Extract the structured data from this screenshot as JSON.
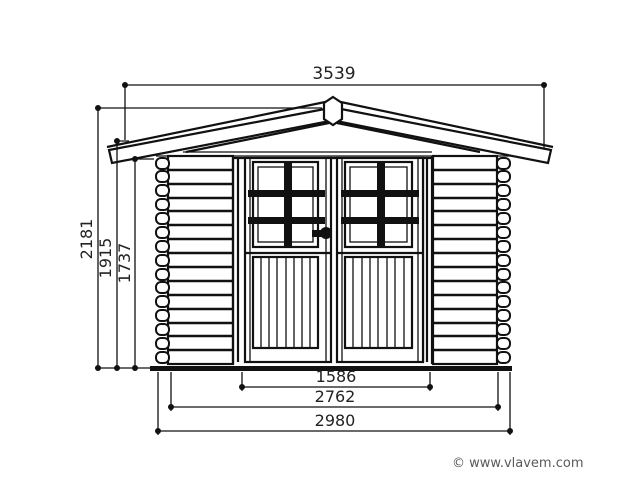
{
  "dims": {
    "roof_width": "3539",
    "ridge_height": "2181",
    "eave_height": "1915",
    "wall_height": "1737",
    "door_opening_width": "1586",
    "wall_outer_width": "2762",
    "overall_width": "2980"
  },
  "footer": {
    "copyright": "© www.vlavem.com"
  },
  "colors": {
    "line": "#111111",
    "dimension_text": "#222222",
    "copyright_text": "#595959",
    "background": "#ffffff"
  }
}
